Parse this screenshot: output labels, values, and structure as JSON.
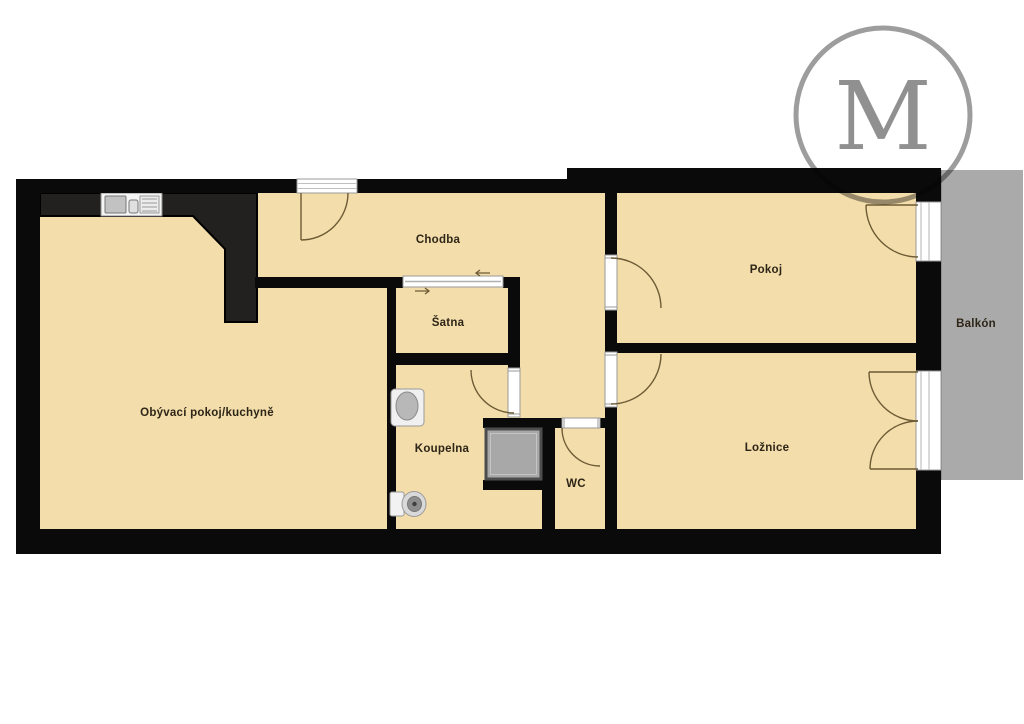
{
  "logo": {
    "letter": "M"
  },
  "palette": {
    "floor": "#f3ddab",
    "wall": "#0a0a0a",
    "counter": "#222120",
    "balcony": "#aaaaaa",
    "door_arc": "#6d5b35",
    "label": "#2d2517",
    "logo_gray": "#9d9d9d"
  },
  "rooms": [
    {
      "id": "chodba",
      "label": "Chodba"
    },
    {
      "id": "satna",
      "label": "Šatna"
    },
    {
      "id": "pokoj",
      "label": "Pokoj"
    },
    {
      "id": "obyvaci",
      "label": "Obývací pokoj/kuchyně"
    },
    {
      "id": "koupelna",
      "label": "Koupelna"
    },
    {
      "id": "wc",
      "label": "WC"
    },
    {
      "id": "loznice",
      "label": "Ložnice"
    },
    {
      "id": "balkon",
      "label": "Balkón"
    }
  ]
}
